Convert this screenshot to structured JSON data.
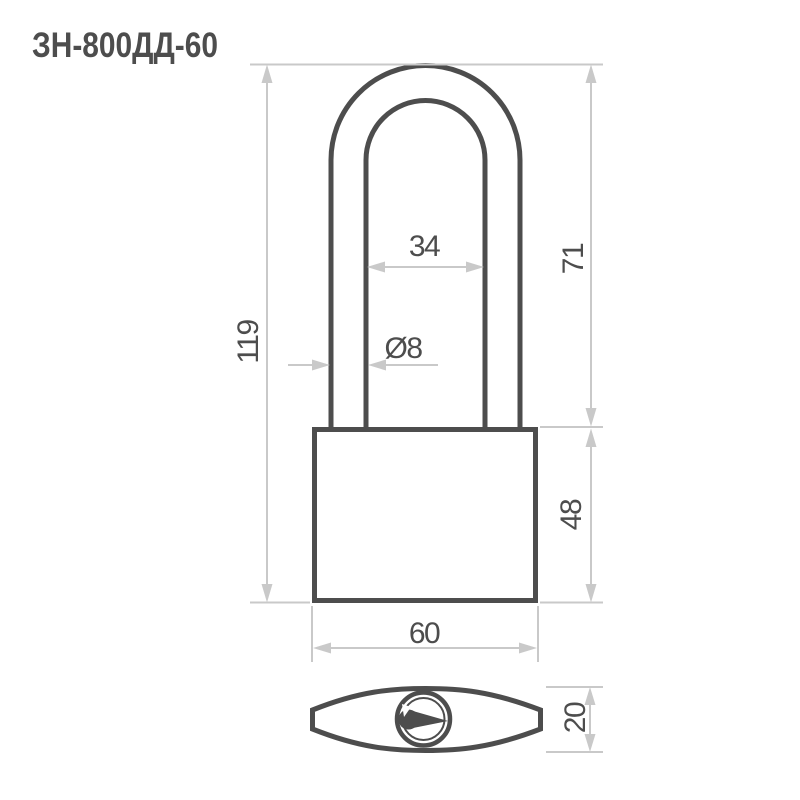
{
  "title": "ЗН-800ДД-60",
  "colors": {
    "line_dark": "#4d4d4d",
    "line_dim": "#c9c9c9",
    "text": "#4d4d4d",
    "background": "#ffffff"
  },
  "dimensions": {
    "total_height": "119",
    "shackle_height": "71",
    "body_height": "48",
    "shackle_inner_width": "34",
    "shackle_rod_diameter": "Ø8",
    "body_width": "60",
    "body_depth": "20"
  }
}
